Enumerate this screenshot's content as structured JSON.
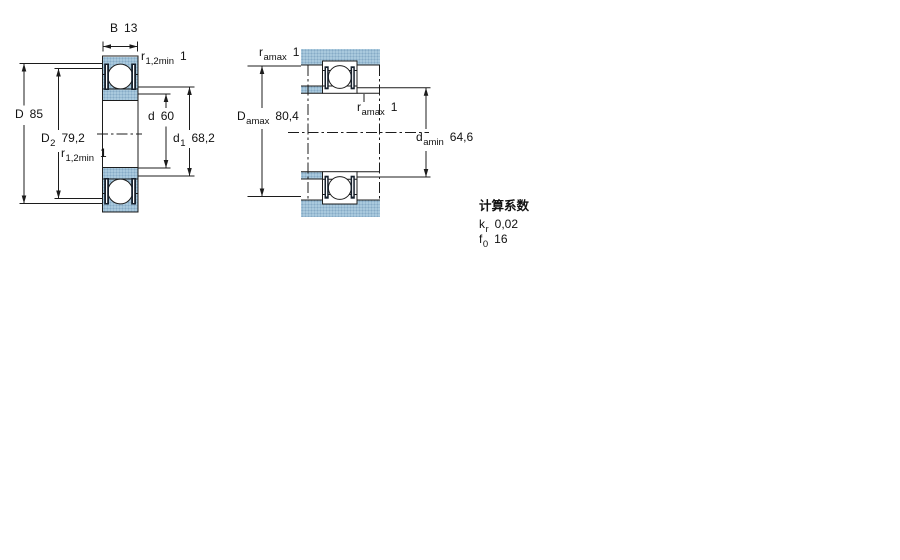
{
  "drawing": {
    "left_labels": {
      "B": {
        "sym": "B",
        "val": "13"
      },
      "D": {
        "sym": "D",
        "val": "85"
      },
      "D2": {
        "sym": "D",
        "sub": "2",
        "val": "79,2"
      },
      "r_top": {
        "sym": "r",
        "sub": "1,2min",
        "val": "1"
      },
      "r_bottom": {
        "sym": "r",
        "sub": "1,2min",
        "val": "1"
      },
      "d": {
        "sym": "d",
        "val": "60"
      },
      "d1": {
        "sym": "d",
        "sub": "1",
        "val": "68,2"
      }
    },
    "right_labels": {
      "r_amax_top": {
        "sym": "r",
        "sub": "amax",
        "val": "1"
      },
      "D_amax": {
        "sym": "D",
        "sub": "amax",
        "val": "80,4"
      },
      "r_amax_mid": {
        "sym": "r",
        "sub": "amax",
        "val": "1"
      },
      "d_amin": {
        "sym": "d",
        "sub": "amin",
        "val": "64,6"
      }
    }
  },
  "calc": {
    "title": "计算系数",
    "rows": [
      {
        "sym": "k",
        "sub": "r",
        "val": "0,02"
      },
      {
        "sym": "f",
        "sub": "0",
        "val": "16"
      }
    ]
  },
  "colors": {
    "blue": "#a9c9dd",
    "blue_dot": "#86abc6",
    "line": "#1c1c1c",
    "seal": "#16202c"
  }
}
